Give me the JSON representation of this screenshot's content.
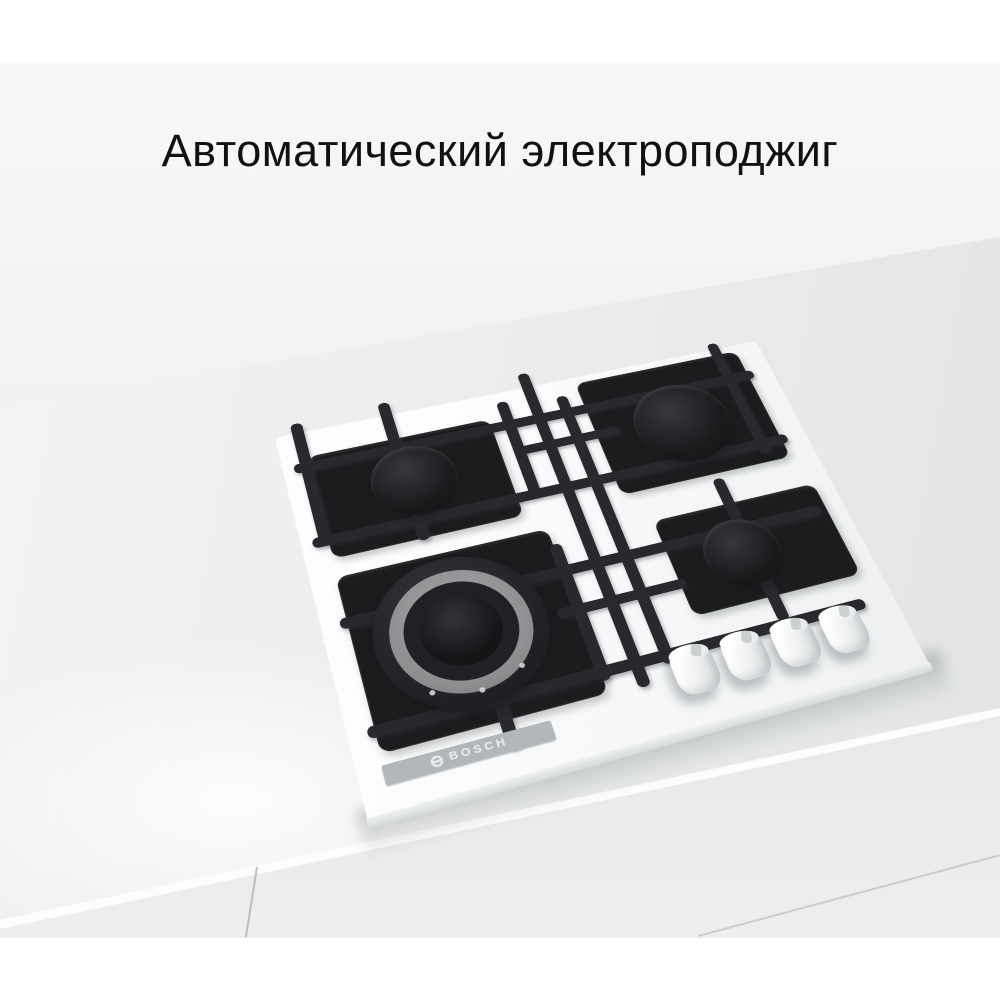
{
  "title": {
    "text": "Автоматический электроподжиг"
  },
  "hob": {
    "brand_label": "BOSCH",
    "subject": "white-glass-gas-hob-with-4-burners-and-cast-iron-grates",
    "knob_count": 4,
    "burners": [
      "back-left-standard",
      "back-right-standard",
      "front-left-wok-double-ring",
      "front-right-small"
    ]
  },
  "colors": {
    "page_background": "#ffffff",
    "title_text": "#111111",
    "countertop": "#eceeee",
    "cabinet_front": "#dcdedf",
    "hob_glass": "#fafbfc",
    "grate": "#202124",
    "wok_ring": "#8b8d8f",
    "logo_strip": "#b4b7b9",
    "logo_text": "#ecedee",
    "knob": "#f3f5f6"
  }
}
